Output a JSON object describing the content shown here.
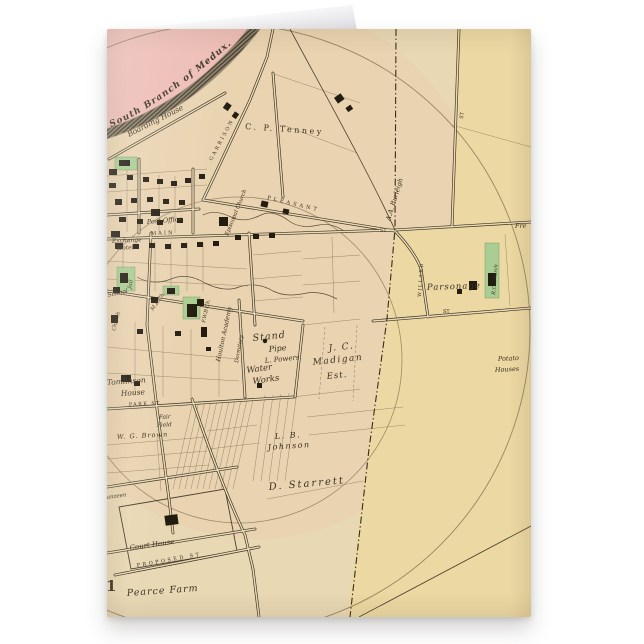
{
  "page": {
    "background": "#ffffff",
    "description": "folded greeting card product mockup with vintage town map on front"
  },
  "colors": {
    "map_base": "#e9d8b4",
    "map_pink": "#edbcb4",
    "map_right_tan": "#ecd8a2",
    "ink": "#3a3122",
    "river": "#4f4739",
    "building_black": "#221c11",
    "building_green": "#a9cd92",
    "circle_line": "#7c6b4b"
  },
  "map": {
    "labels": {
      "river": "South Branch of Medux.",
      "boarding_house": "Boarding House",
      "cp_tenney": "C. P. Tenney",
      "garrison_st": "GARRISON",
      "pleasant_st": "PLEASANT",
      "main_st": "MAIN",
      "st_junction": "ST.",
      "post_office": "Post Office",
      "exchange": "Exchange",
      "hotel": "Hotel",
      "jail": "Jail",
      "episcopal_church": "Episcopal Church",
      "school": "School",
      "church": "Church",
      "me_church": "M.E.Ch.",
      "fwb_church": "F.W.B.Ch.",
      "academy": "Houlton Academy",
      "dormitory": "Dormitory",
      "stand": "Stand",
      "pipe": "Pipe",
      "l_powers": "L. Powers",
      "water": "Water",
      "works": "Works",
      "jc": "J. C.",
      "madigan": "Madigan",
      "est": "Est.",
      "burleigh": "A.A. Burleigh",
      "st_top_right": "ST",
      "willard_st": "WILLARD",
      "st_right": "ST",
      "parsonage": "Parsonage",
      "rc_church": "R.C. Church",
      "fre": "Fre",
      "potato": "Potato",
      "houses": "Houses",
      "tomlinson": "Tomlinson",
      "house": "House",
      "park_st": "PARK ST",
      "fair": "Fair",
      "field": "Field",
      "wg_brown": "W. G. Brown",
      "lb": "L. B.",
      "johnson": "Johnson",
      "d_starrett": "D. Starrett",
      "court_house": "Court House",
      "proposed_st": "PROPOSED ST",
      "pearce_farm": "Pearce Farm",
      "plate_number": "1",
      "anzeen": "anzeen"
    }
  }
}
